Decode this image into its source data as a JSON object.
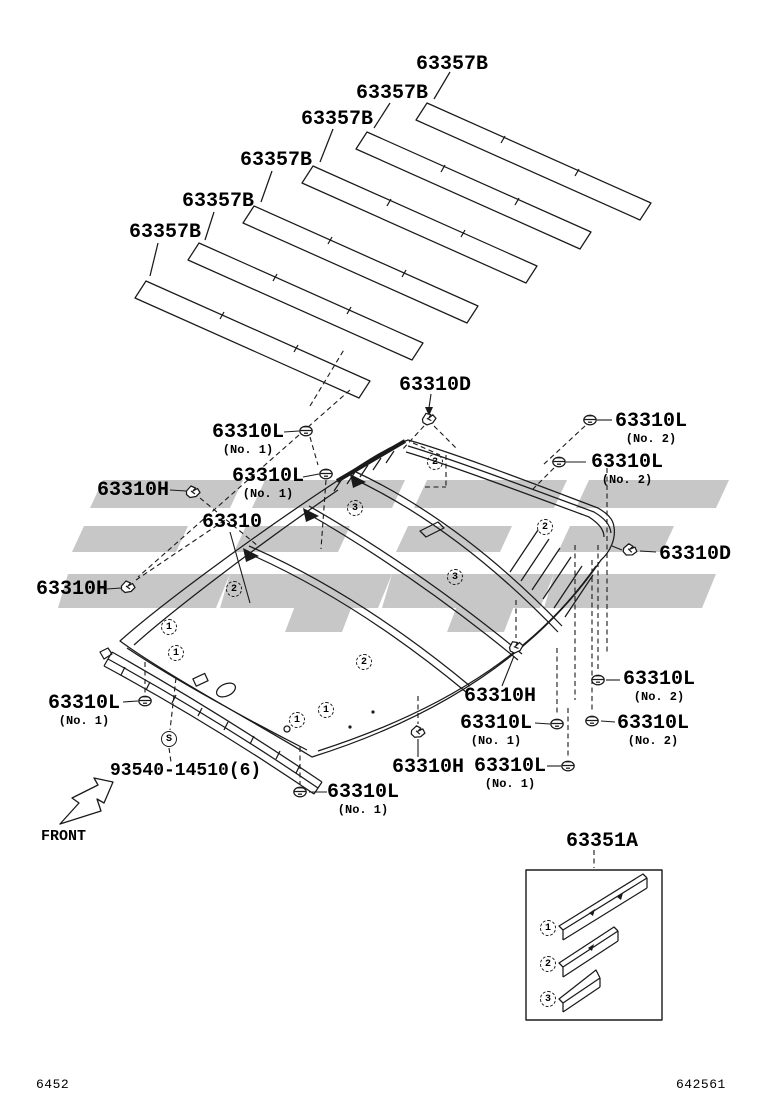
{
  "page": {
    "background": "#ffffff",
    "ink_color": "#1a1a1a",
    "footer_left": "6452",
    "footer_right": "642561"
  },
  "watermark": {
    "color": "#c7c7c7"
  },
  "front_arrow": {
    "label": "FRONT"
  },
  "s_symbol": "S",
  "inset_box": {
    "items": [
      "1",
      "2",
      "3"
    ]
  },
  "callouts": [
    "1",
    "1",
    "2",
    "3",
    "2",
    "2",
    "1",
    "1",
    "3",
    "2"
  ],
  "labels": [
    {
      "text": "63357B"
    },
    {
      "text": "63357B"
    },
    {
      "text": "63357B"
    },
    {
      "text": "63357B"
    },
    {
      "text": "63357B"
    },
    {
      "text": "63357B"
    },
    {
      "text": "63310D"
    },
    {
      "text": "63310L",
      "sub": "(No. 1)"
    },
    {
      "text": "63310L",
      "sub": "(No. 2)"
    },
    {
      "text": "63310L",
      "sub": "(No. 1)"
    },
    {
      "text": "63310L",
      "sub": "(No. 2)"
    },
    {
      "text": "63310H"
    },
    {
      "text": "63310"
    },
    {
      "text": "63310D"
    },
    {
      "text": "63310H"
    },
    {
      "text": "63310L",
      "sub": "(No. 1)"
    },
    {
      "text": "63310L",
      "sub": "(No. 2)"
    },
    {
      "text": "63310H"
    },
    {
      "text": "63310L",
      "sub": "(No. 1)"
    },
    {
      "text": "63310L",
      "sub": "(No. 2)"
    },
    {
      "text": "93540-14510(6)"
    },
    {
      "text": "63310H"
    },
    {
      "text": "63310L",
      "sub": "(No. 1)"
    },
    {
      "text": "63310L",
      "sub": "(No. 1)"
    },
    {
      "text": "63351A"
    }
  ]
}
